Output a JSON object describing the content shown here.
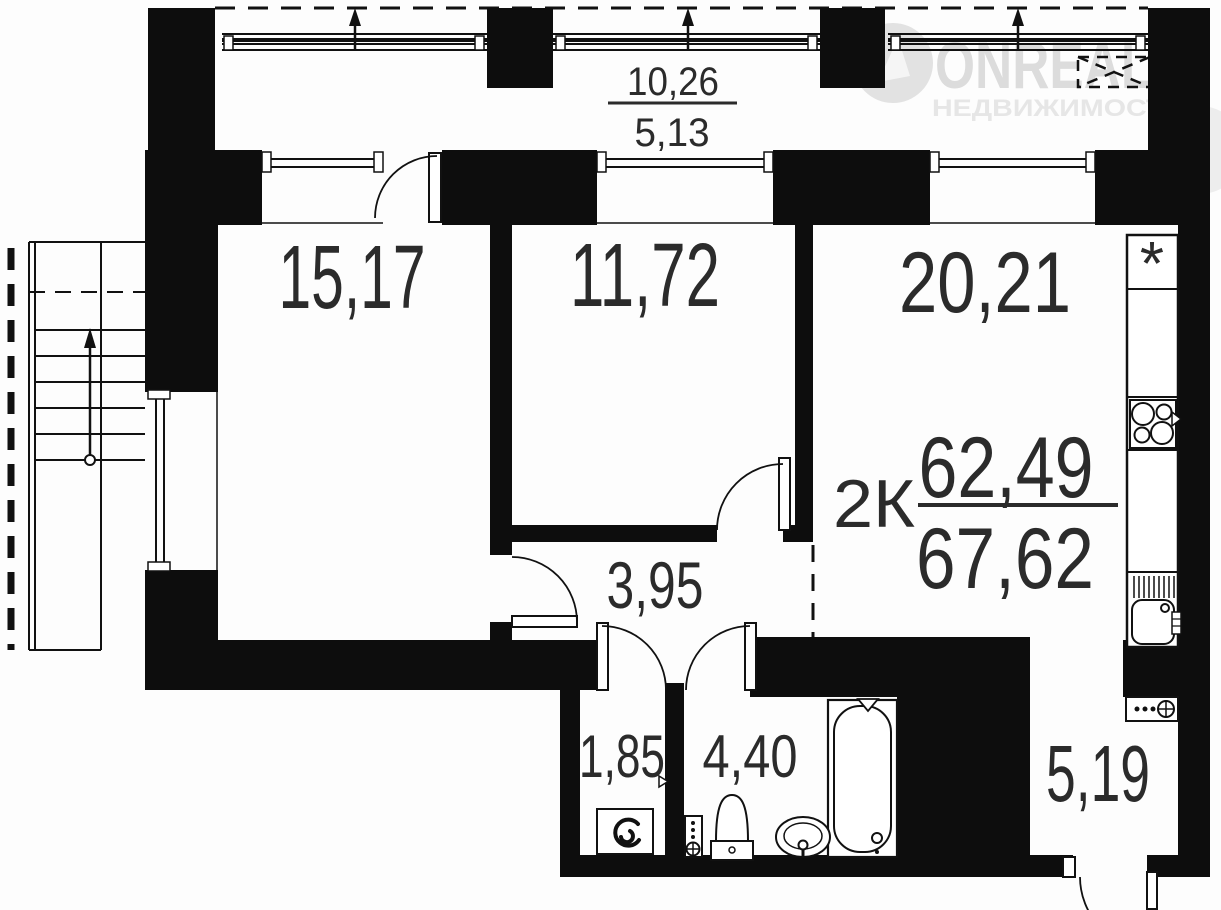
{
  "watermark": {
    "brand": "ONREALT",
    "tagline": "НЕДВИЖИМОСТЬ"
  },
  "summary": {
    "type_label": "2К",
    "area_living": "62,49",
    "area_total": "67,62"
  },
  "balcony": {
    "area_full": "10,26",
    "area_reduced": "5,13"
  },
  "rooms": {
    "living1": "15,17",
    "living2": "11,72",
    "kitchen": "20,21",
    "hallway": "3,95",
    "laundry": "1,85",
    "bathroom": "4,40",
    "entry": "5,19"
  },
  "symbols": {
    "vent": "*"
  }
}
